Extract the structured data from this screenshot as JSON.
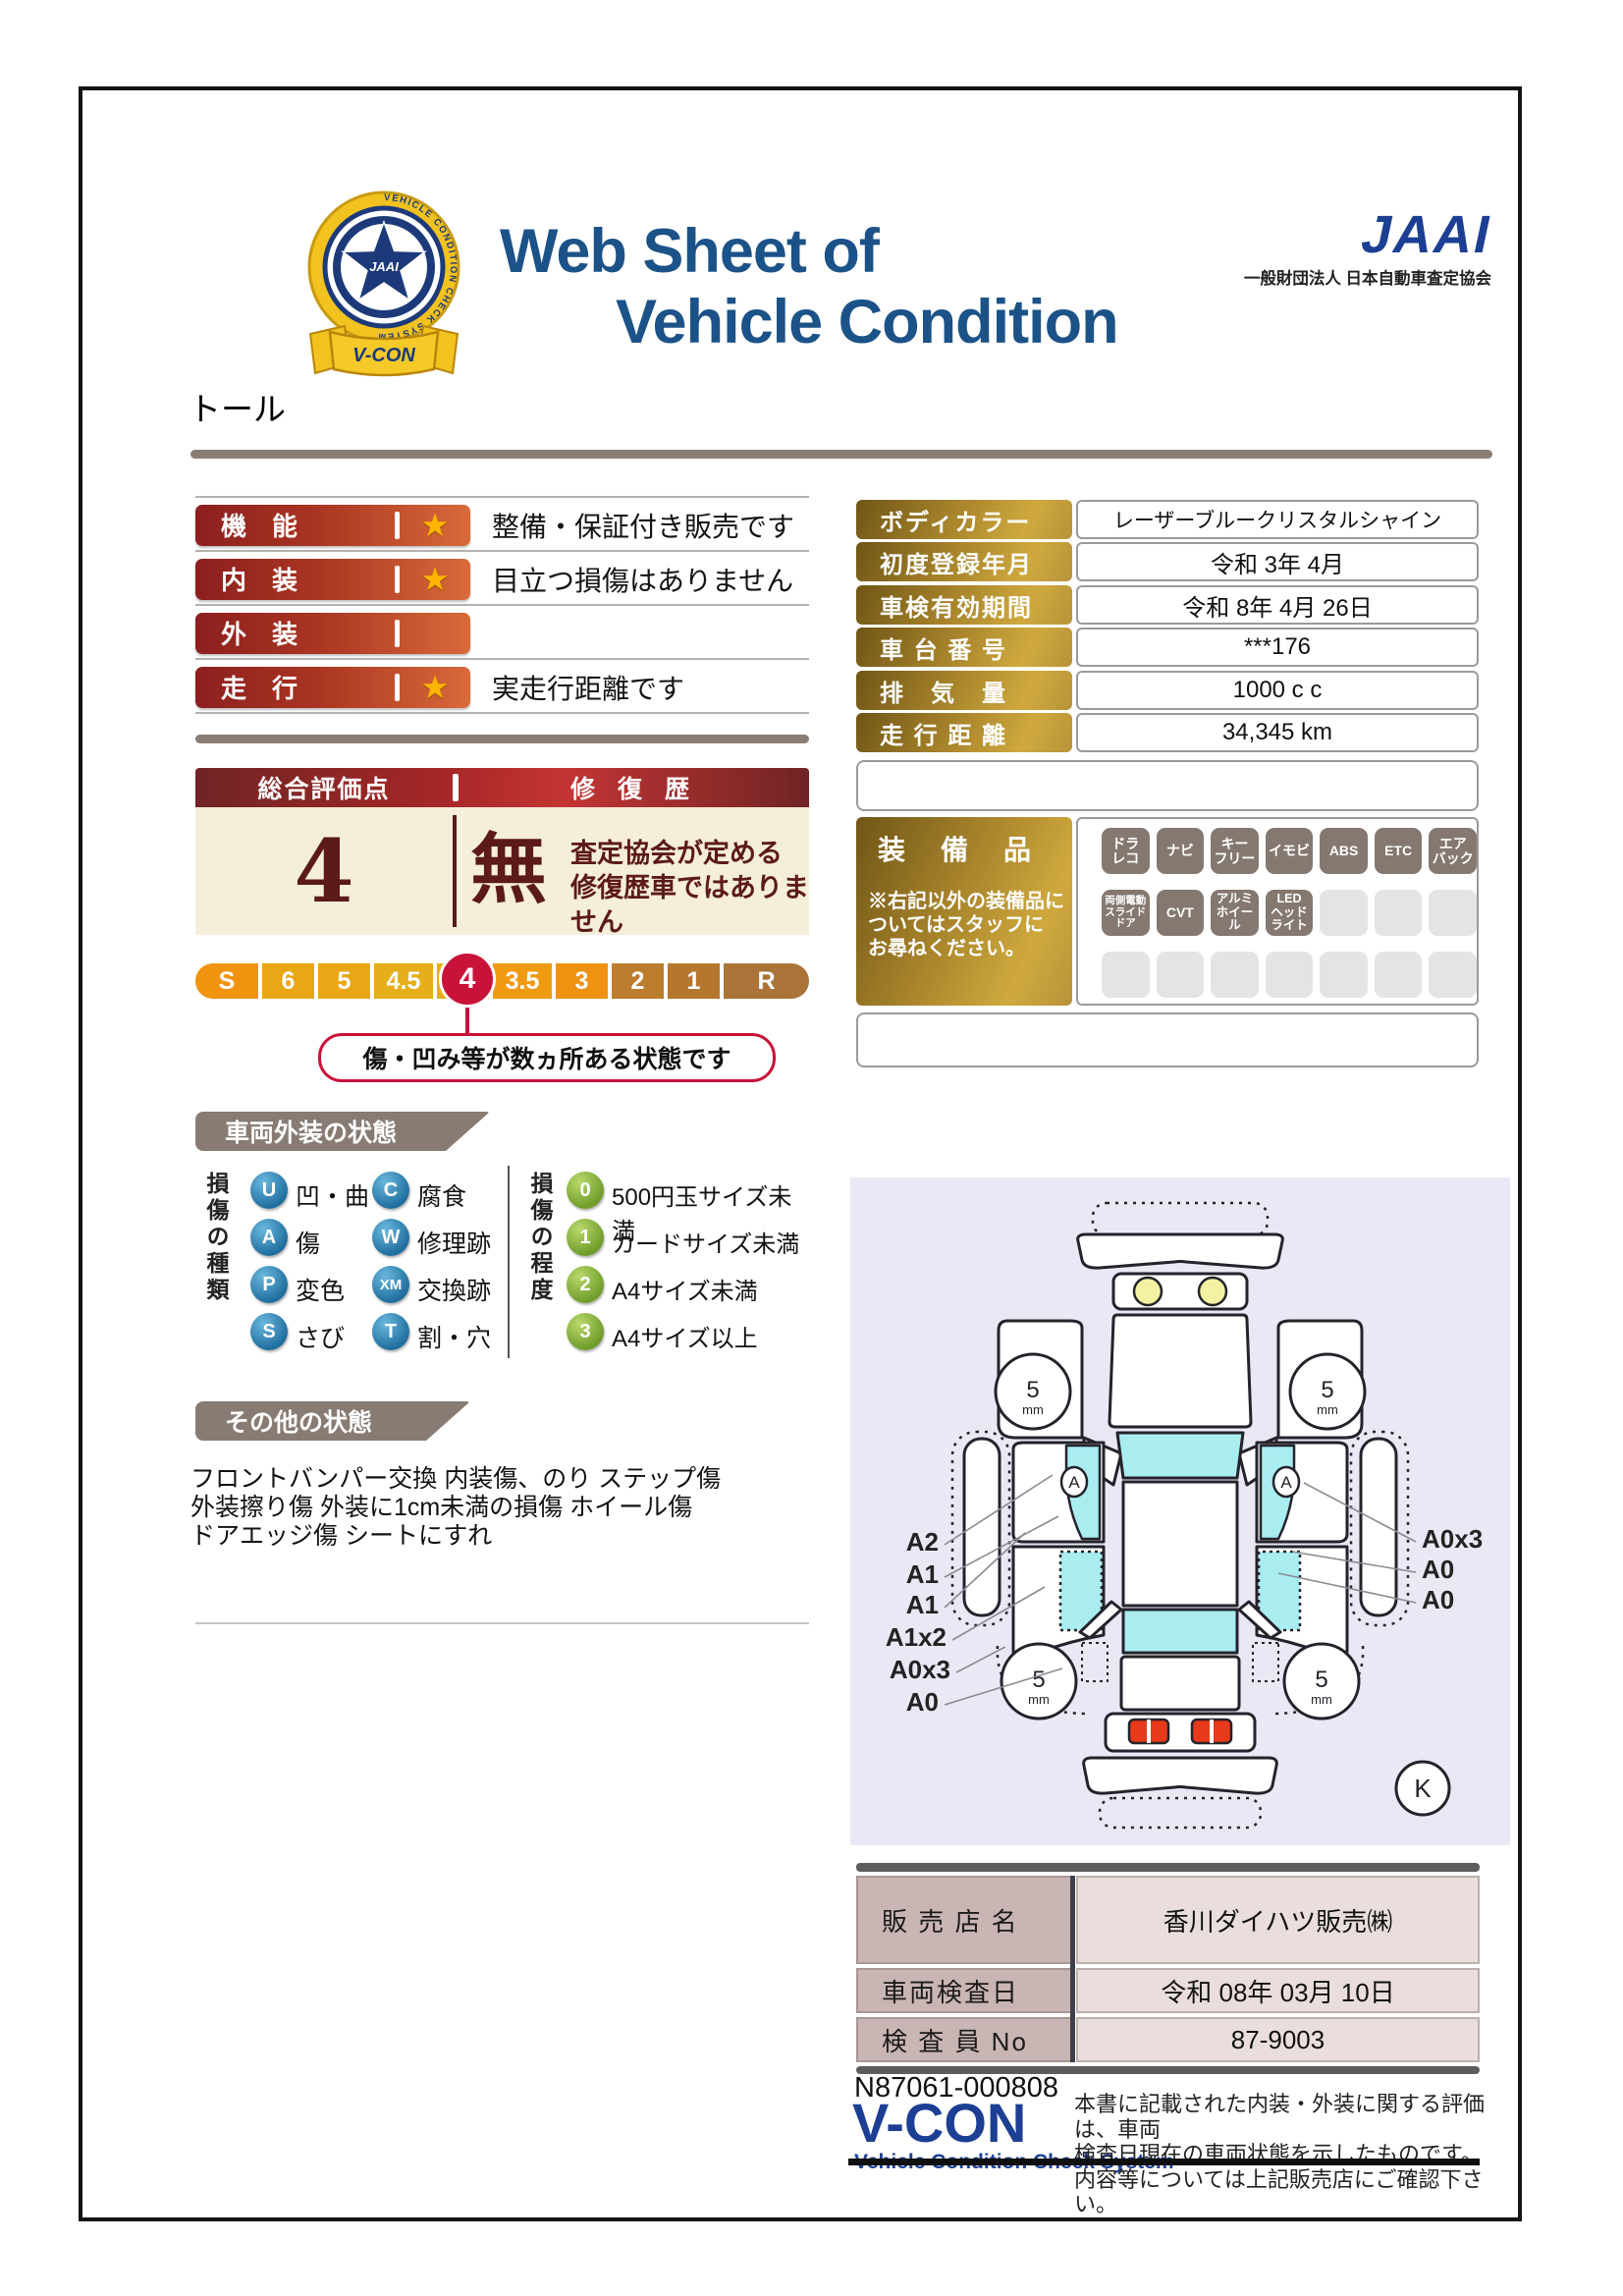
{
  "colors": {
    "title_navy": "#1b5288",
    "jaai_blue": "#1c3f94",
    "badge_red": "#8c1f1f",
    "badge_orange": "#d96a3a",
    "gold_dark": "#6f5516",
    "gold_light": "#cfa93e",
    "score_cream": "#f5eedb",
    "maroon": "#5c1a1a",
    "scale_red": "#c9123a",
    "tab_gray": "#877b73",
    "legend_blue": "#1f6e9e",
    "legend_green": "#6f9c2a",
    "glass_cyan": "#a9edf1",
    "diagram_bg": "#e8e9f5",
    "table_mauve": "#c9b5b3",
    "table_pink": "#e9dedc"
  },
  "header": {
    "title_line1": "Web Sheet of",
    "title_line2": "Vehicle Condition",
    "jaai_logo": "JAAI",
    "jaai_subtitle": "一般財団法人 日本自動車査定協会",
    "emblem_star_text": "JAAI",
    "emblem_ring_text": "VEHICLE CONDITION CHECK SYSTEM",
    "emblem_ribbon": "V-CON"
  },
  "vehicle_name": "トール",
  "ratings": {
    "items": [
      {
        "label": "機　能",
        "star": "★",
        "desc": "整備・保証付き販売です"
      },
      {
        "label": "内　装",
        "star": "★",
        "desc": "目立つ損傷はありません"
      },
      {
        "label": "外　装",
        "star": "",
        "desc": ""
      },
      {
        "label": "走　行",
        "star": "★",
        "desc": "実走行距離です"
      }
    ]
  },
  "score": {
    "header_left": "総合評価点",
    "header_right": "修 復 歴",
    "value": "4",
    "repair": "無",
    "repair_desc": "査定協会が定める\n修復歴車ではありません"
  },
  "scale": {
    "pills": [
      "S",
      "6",
      "5",
      "4.5",
      "4",
      "3.5",
      "3",
      "2",
      "1",
      "R"
    ],
    "selected": "4",
    "callout": "傷・凹み等が数ヵ所ある状態です"
  },
  "details": {
    "rows": [
      {
        "label": "ボディカラー",
        "value": "レーザーブルークリスタルシャイン"
      },
      {
        "label": "初度登録年月",
        "value": "令和 3年 4月"
      },
      {
        "label": "車検有効期間",
        "value": "令和 8年 4月 26日"
      },
      {
        "label": "車 台 番 号",
        "value": "***176"
      },
      {
        "label": "排　気　量",
        "value": "1000 c c"
      },
      {
        "label": "走 行 距 離",
        "value": "34,345 km"
      }
    ]
  },
  "equipment": {
    "title": "装　備　品",
    "note": "※右記以外の装備品に\nついてはスタッフに\nお尋ねください。",
    "row1": [
      "ドラ\nレコ",
      "ナビ",
      "キー\nフリー",
      "イモビ",
      "ABS",
      "ETC",
      "エア\nバック"
    ],
    "row2": [
      "両側電動\nスライド\nドア",
      "CVT",
      "アルミ\nホイール",
      "LED\nヘッド\nライト"
    ]
  },
  "exterior": {
    "title": "車両外装の状態",
    "kind_label": "損傷の種類",
    "kinds": [
      {
        "code": "U",
        "label": "凹・曲"
      },
      {
        "code": "C",
        "label": "腐食"
      },
      {
        "code": "A",
        "label": "傷"
      },
      {
        "code": "W",
        "label": "修理跡"
      },
      {
        "code": "P",
        "label": "変色"
      },
      {
        "code": "XM",
        "label": "交換跡"
      },
      {
        "code": "S",
        "label": "さび"
      },
      {
        "code": "T",
        "label": "割・穴"
      }
    ],
    "degree_label": "損傷の程度",
    "degrees": [
      {
        "code": "0",
        "label": "500円玉サイズ未満"
      },
      {
        "code": "1",
        "label": "カードサイズ未満"
      },
      {
        "code": "2",
        "label": "A4サイズ未満"
      },
      {
        "code": "3",
        "label": "A4サイズ以上"
      }
    ]
  },
  "other": {
    "title": "その他の状態",
    "text": "フロントバンパー交換 内装傷、のり ステップ傷\n外装擦り傷 外装に1cm未満の損傷 ホイール傷\nドアエッジ傷 シートにすれ"
  },
  "diagram": {
    "tread_value": "5",
    "tread_unit": "mm",
    "door_marker": "A",
    "labels_left": [
      "A2",
      "A1",
      "A1",
      "A1x2",
      "A0x3",
      "A0"
    ],
    "labels_right": [
      "A0x3",
      "A0",
      "A0"
    ],
    "corner_mark": "K"
  },
  "dealer": {
    "rows": [
      {
        "label": "販 売 店 名",
        "value": "香川ダイハツ販売㈱"
      },
      {
        "label": "車両検査日",
        "value": "令和 08年 03月 10日"
      },
      {
        "label": "検 査 員 No",
        "value": "87-9003"
      }
    ]
  },
  "footer": {
    "cert_no": "N87061-000808",
    "vcon": "V-CON",
    "vcon_sub": "Vehicle Condition Check System",
    "note": "本書に記載された内装・外装に関する評価は、車両\n検査日現在の車両状態を示したものです。\n内容等については上記販売店にご確認下さい。"
  }
}
